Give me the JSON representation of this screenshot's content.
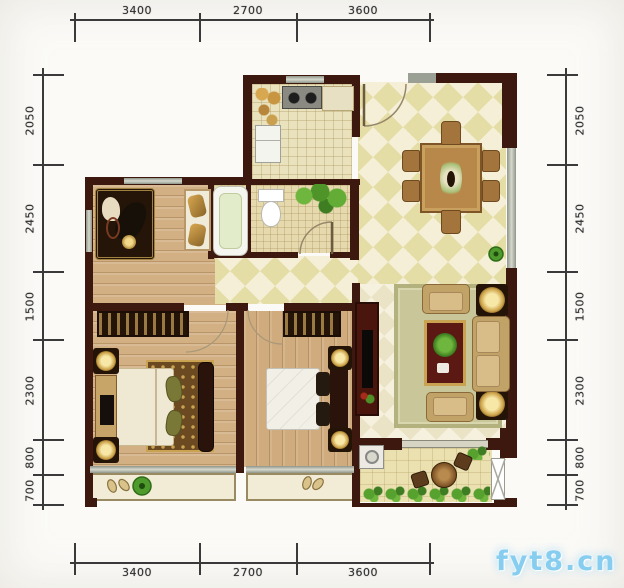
{
  "canvas": {
    "width": 624,
    "height": 588
  },
  "watermark": {
    "text": "fyt8.cn",
    "color": "#86cdf0"
  },
  "rulers": {
    "top": {
      "labels": [
        "3400",
        "2700",
        "3600"
      ]
    },
    "bottom": {
      "labels": [
        "3400",
        "2700",
        "3600"
      ]
    },
    "left": {
      "labels": [
        "2050",
        "2450",
        "1500",
        "2300",
        "800",
        "700"
      ]
    },
    "right": {
      "labels": [
        "2050",
        "2450",
        "1500",
        "2300",
        "800",
        "700"
      ]
    }
  },
  "colors": {
    "wall": "#3d180e",
    "wood_floor": "#d2b083",
    "kitchen_tile": "#e9e2bd",
    "diamond_dark": "#e5dda6",
    "diamond_light": "#f4efd6",
    "rug_sage": "#c9c79a",
    "accent_gold": "#c89a4a",
    "plant_green": "#4e9428",
    "watermark_blue": "#86cdf0"
  },
  "rooms": [
    {
      "name": "kitchen",
      "furniture": [
        "stove",
        "counter",
        "refrigerator",
        "food-items"
      ]
    },
    {
      "name": "dining-hall",
      "furniture": [
        "dining-table",
        "six-chairs",
        "potted-plant",
        "entry-door-arc"
      ]
    },
    {
      "name": "bathroom",
      "furniture": [
        "bathtub",
        "toilet",
        "shower-plants",
        "door-arc"
      ]
    },
    {
      "name": "study-room",
      "furniture": [
        "ornate-rug",
        "piano-shape",
        "cushion-shelf"
      ]
    },
    {
      "name": "master-bedroom",
      "furniture": [
        "wardrobe",
        "double-bed",
        "dresser-tv",
        "lamps",
        "bay-slippers",
        "bay-plant"
      ]
    },
    {
      "name": "second-bedroom",
      "furniture": [
        "wardrobe",
        "double-bed",
        "nightstand-lamps",
        "bay-slippers"
      ]
    },
    {
      "name": "living-room",
      "furniture": [
        "area-rug",
        "sofa",
        "armchairs",
        "coffee-table",
        "tv-cabinet",
        "end-table-lamps"
      ]
    },
    {
      "name": "balcony",
      "furniture": [
        "washing-machine",
        "bistro-table",
        "chairs",
        "plant-border",
        "side-window"
      ]
    }
  ]
}
